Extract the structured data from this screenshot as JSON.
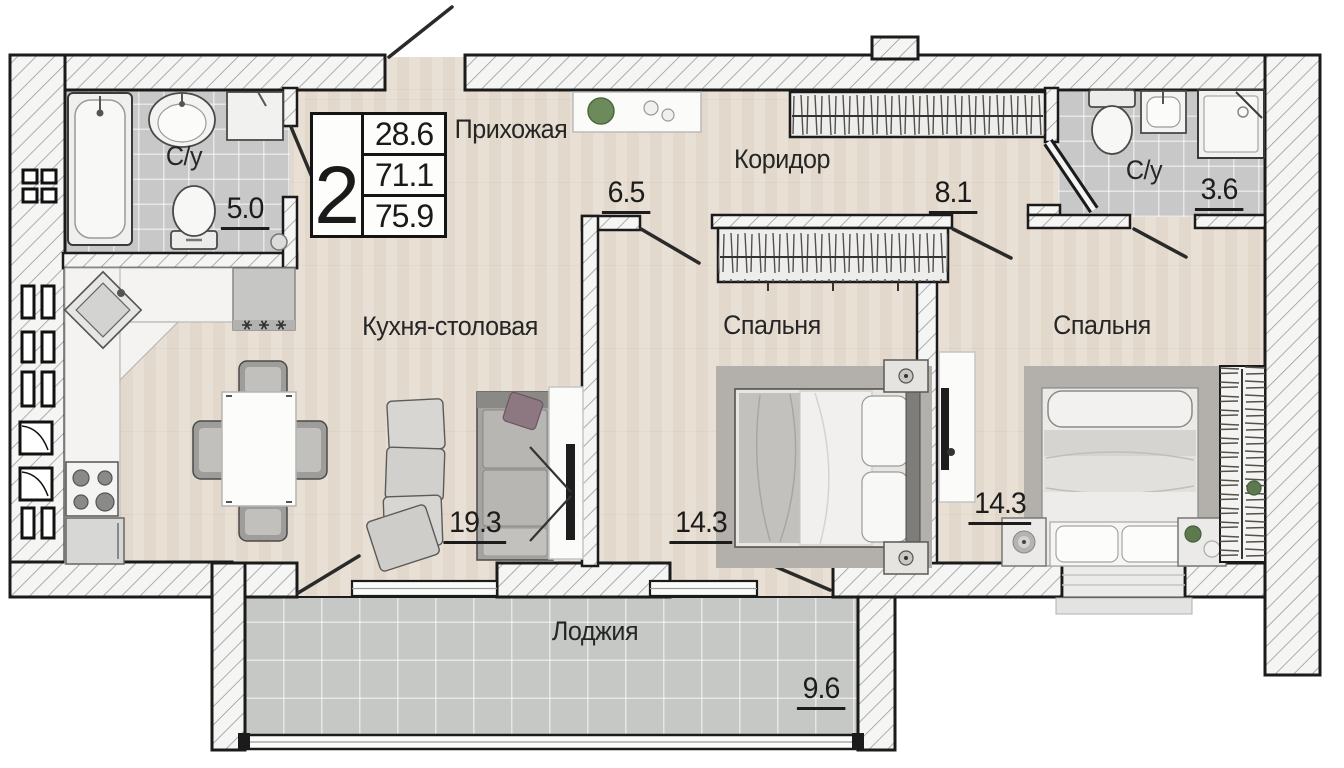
{
  "title_block": {
    "rooms_count": "2",
    "living_area": "28.6",
    "apartment_area": "71.1",
    "total_area": "75.9"
  },
  "rooms": [
    {
      "id": "hallway",
      "label": "Прихожая",
      "area": "6.5"
    },
    {
      "id": "corridor",
      "label": "Коридор",
      "area": "8.1"
    },
    {
      "id": "bathroom-left",
      "label": "С/у",
      "area": "5.0"
    },
    {
      "id": "bathroom-right",
      "label": "С/у",
      "area": "3.6"
    },
    {
      "id": "kitchen-dining",
      "label": "Кухня-столовая",
      "area": "19.3"
    },
    {
      "id": "bedroom-middle",
      "label": "Спальня",
      "area": "14.3"
    },
    {
      "id": "bedroom-right",
      "label": "Спальня",
      "area": "14.3"
    },
    {
      "id": "loggia",
      "label": "Лоджия",
      "area": "9.6"
    }
  ],
  "colors": {
    "wall_line": "#1b1b1b",
    "wood_floor": "#e7ddd0",
    "tile_floor": "#c8c8c8",
    "loggia_floor": "#c6c8c6",
    "plant_green": "#5d7a4e"
  }
}
